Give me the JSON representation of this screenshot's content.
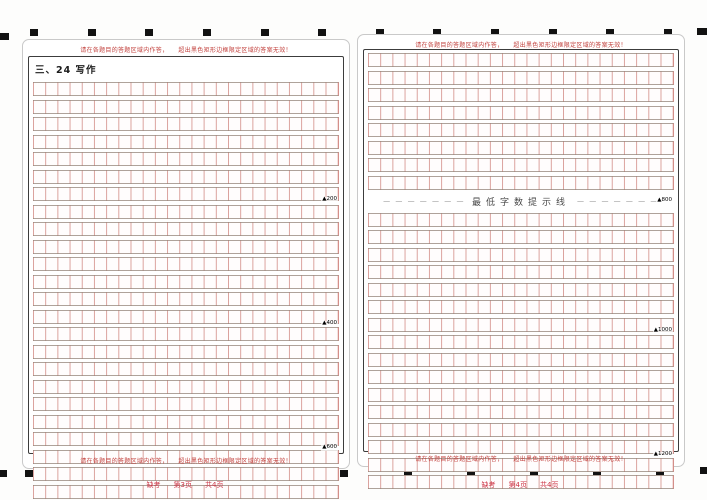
{
  "colors": {
    "grid_line_red": "#cb7a73",
    "row_line_gray": "#948479",
    "box_border": "#3c3c3c",
    "warning_red": "#c2403c",
    "footer_red": "#cc3344",
    "mark_black": "#121212",
    "minline_text": "#4a4a4a"
  },
  "timing_marks": {
    "top_count": 12,
    "bottom_count": 11
  },
  "warnings": {
    "part1": "请在各题目的答题区域内作答，",
    "part2": "超出黑色矩形边框限定区域的答案无效！"
  },
  "minline": {
    "dashes_left": "— — — — — — —",
    "dashes_right": "— — — — — — —",
    "label": "最低字数提示线",
    "marker": "▲800"
  },
  "sheets": [
    {
      "title": "三、24 写作",
      "footer": {
        "absent": "缺考",
        "page": "第3页",
        "total": "共4页"
      },
      "grid_cols": 25,
      "sections": [
        {
          "type": "grid",
          "rows": 24,
          "markers": [
            {
              "after_row": 8,
              "label": "▲200"
            },
            {
              "after_row": 16,
              "label": "▲400"
            },
            {
              "after_row": 24,
              "label": "▲600"
            }
          ]
        }
      ]
    },
    {
      "title": "",
      "footer": {
        "absent": "缺考",
        "page": "第4页",
        "total": "共4页"
      },
      "grid_cols": 25,
      "sections": [
        {
          "type": "grid",
          "rows": 8,
          "markers": []
        },
        {
          "type": "minline"
        },
        {
          "type": "grid",
          "rows": 16,
          "markers": [
            {
              "after_row": 8,
              "label": "▲1000"
            },
            {
              "after_row": 16,
              "label": "▲1200"
            }
          ]
        }
      ]
    }
  ]
}
